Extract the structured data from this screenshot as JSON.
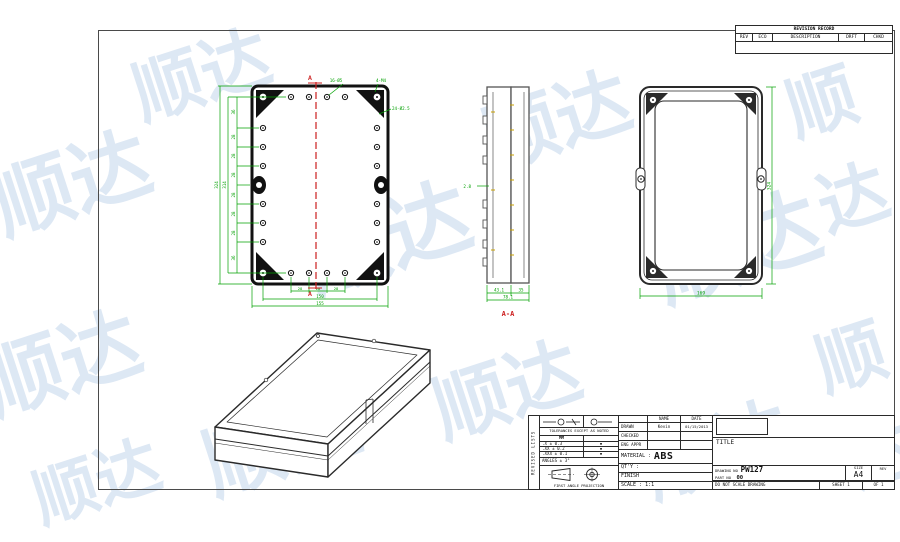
{
  "watermark": {
    "text": "顺达",
    "color": "#c3d6ec"
  },
  "revision_record": {
    "title": "REVISION RECORD",
    "col_rev": "REV",
    "col_eco": "ECO",
    "col_description": "DESCRIPTION",
    "col_drft": "DRFT",
    "col_chkd": "CHKD"
  },
  "plan_view": {
    "hole_callout": "16-Ø5",
    "corner_callout": "4-M4",
    "small_hole_callout": "24-Ø2.5",
    "section_marker_top": "A",
    "section_marker_bottom": "A",
    "v_chain": [
      "36",
      "28",
      "28",
      "28",
      "28",
      "28",
      "28",
      "36"
    ],
    "v_total_inner": "314",
    "v_total_outer": "324",
    "h_chain": [
      "28",
      "28",
      "28"
    ],
    "h_total_inner": "150",
    "h_total_outer": "155"
  },
  "section_view": {
    "label": "A-A",
    "wall_thickness": "2.8",
    "dim_left": "43.1",
    "dim_right": "35",
    "dim_total": "78.1"
  },
  "back_view": {
    "dim_width": "169",
    "dim_height": "324"
  },
  "title_block": {
    "side_strip": "REVISED LISTS",
    "tolerances_heading": "TOLERANCES EXCEPT AS NOTED",
    "unit": "MM",
    "tol_rows": [
      ".X ± 0.3",
      ".XX ± 0.2",
      ".XXX ± 0.1"
    ],
    "tol_marks": [
      "▪",
      "▪",
      "▪"
    ],
    "angles": "ANGLES ± 3°",
    "projection_label": "FIRST ANGLE PROJECTION",
    "name_header": "NAME",
    "date_header": "DATE",
    "drawn_label": "DRAWN",
    "drawn_name": "Kevin",
    "drawn_date": "01/15/2013",
    "checked_label": "CHECKED",
    "eng_appr_label": "ENG APPR",
    "material_label": "MATERIAL :",
    "material_value": "ABS",
    "qty_label": "QT'Y :",
    "finish_label": "FINISH",
    "scale_label": "SCALE : 1:1",
    "title_label": "TITLE",
    "drawing_no_label": "DRAWING NO",
    "drawing_no_value": "PW127",
    "part_no_label": "PART NO",
    "part_no_value": "00",
    "size_label": "SIZE",
    "size_value": "A4",
    "rev_label": "REV",
    "do_not_scale": "DO NOT SCALE DRAWING",
    "sheet_label": "SHEET 1",
    "of_label": "OF 1"
  }
}
